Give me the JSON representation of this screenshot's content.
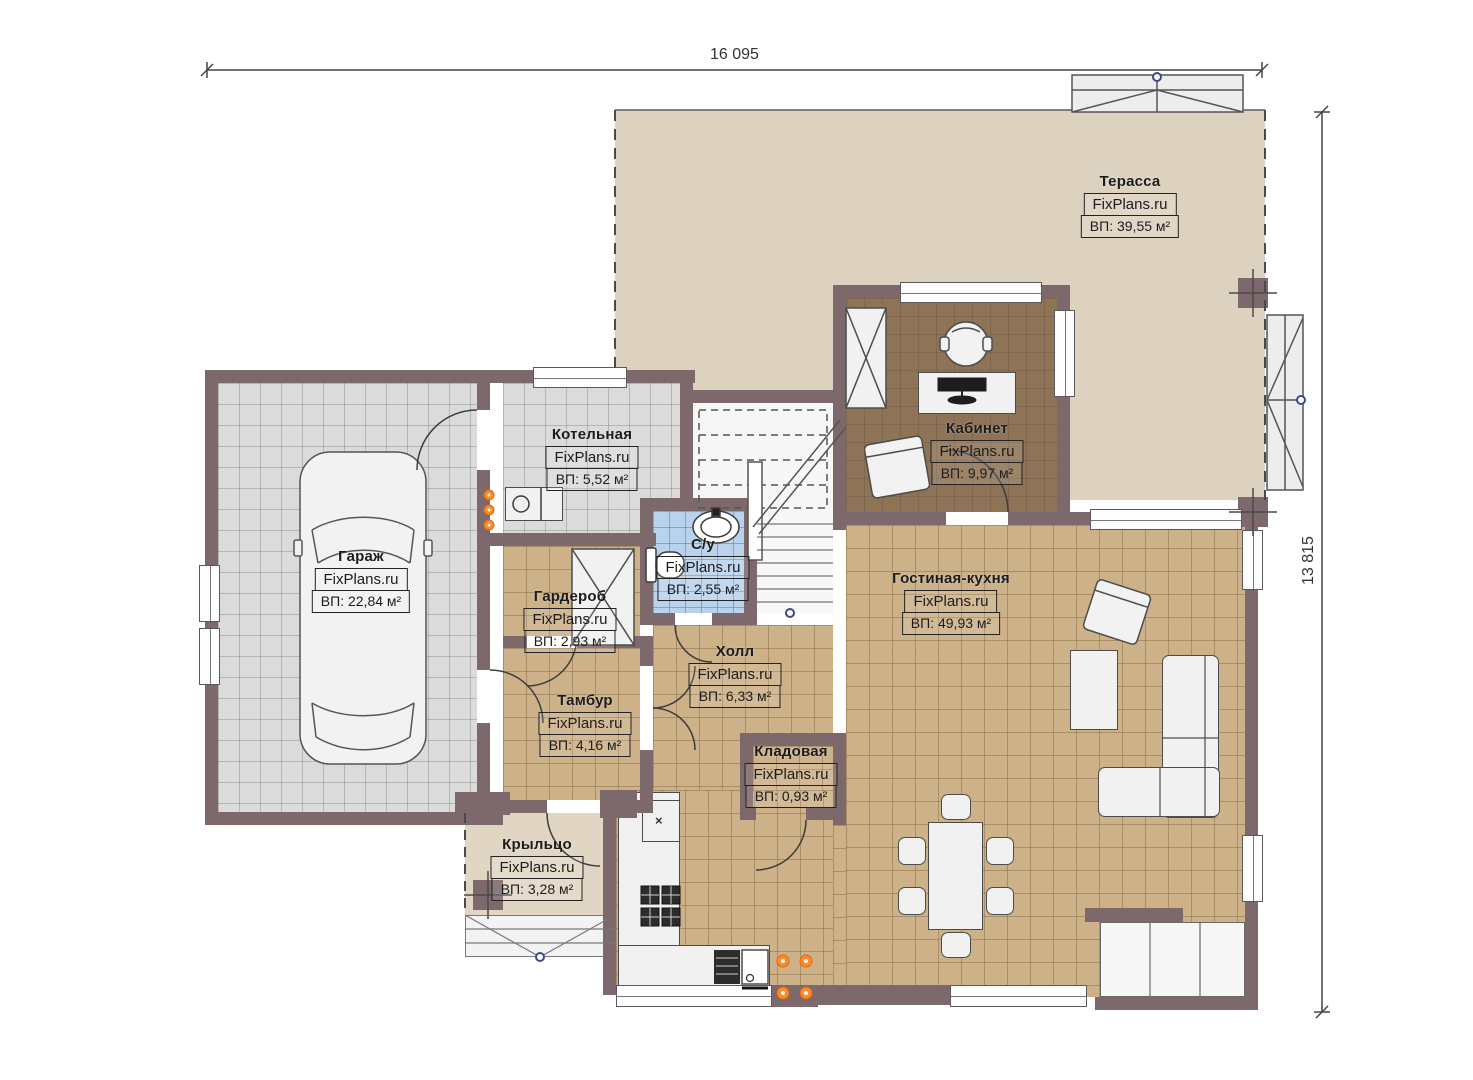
{
  "watermark": "FixPlans.ru",
  "dimensions": {
    "width_label": "16 095",
    "height_label": "13 815"
  },
  "rooms": [
    {
      "name": "Терасса",
      "area": "ВП: 39,55 м²"
    },
    {
      "name": "Кабинет",
      "area": "ВП: 9,97 м²"
    },
    {
      "name": "Котельная",
      "area": "ВП: 5,52 м²"
    },
    {
      "name": "Гараж",
      "area": "ВП: 22,84 м²"
    },
    {
      "name": "Гардероб",
      "area": "ВП: 2,93 м²"
    },
    {
      "name": "С/у",
      "area": "ВП: 2,55 м²"
    },
    {
      "name": "Холл",
      "area": "ВП: 6,33 м²"
    },
    {
      "name": "Тамбур",
      "area": "ВП: 4,16 м²"
    },
    {
      "name": "Гостиная-кухня",
      "area": "ВП: 49,93 м²"
    },
    {
      "name": "Кладовая",
      "area": "ВП: 0,93 м²"
    },
    {
      "name": "Крыльцо",
      "area": "ВП: 3,28 м²"
    }
  ],
  "fridge_mark": "×",
  "colors": {
    "wall": "#7d686b",
    "terrace_floor": "#ddd2c0",
    "living_floor": "#ccb189",
    "garage_floor": "#dbdbdb",
    "office_floor": "#8e7356",
    "bathroom_floor": "#b9d3ed",
    "radiator_orange": "#ff8a2a",
    "node_blue": "#3b4a8c"
  }
}
